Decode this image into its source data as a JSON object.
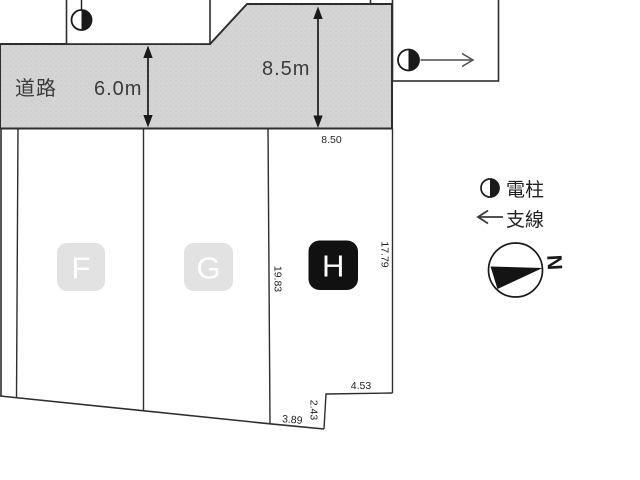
{
  "road": {
    "name_label": "道路",
    "width_label": "6.0m",
    "upper_width_label": "8.5m"
  },
  "plots": {
    "f_label": "F",
    "g_label": "G",
    "h_label": "H"
  },
  "dimensions": {
    "h_frontage": "8.50",
    "h_left_depth": "19.83",
    "h_right_depth": "17.79",
    "h_bottom_step_width": "4.53",
    "h_bottom_step_height": "2.43",
    "h_bottom_edge": "3.89"
  },
  "legend": {
    "pole_label": "電柱",
    "guy_wire_label": "支線",
    "north_label": "N"
  },
  "icons": {
    "utility_pole": "half-filled-circle",
    "guy_wire": "left-arrow",
    "compass": "north-wedge-circle"
  },
  "colors": {
    "road_fill": "#d4d4d4",
    "outline": "#2e2e2e",
    "plot_badge_light": "#e2e2e2",
    "plot_badge_dark": "#111111",
    "road_text": "#3b3b3b",
    "dim_text": "#1f1f1f"
  }
}
